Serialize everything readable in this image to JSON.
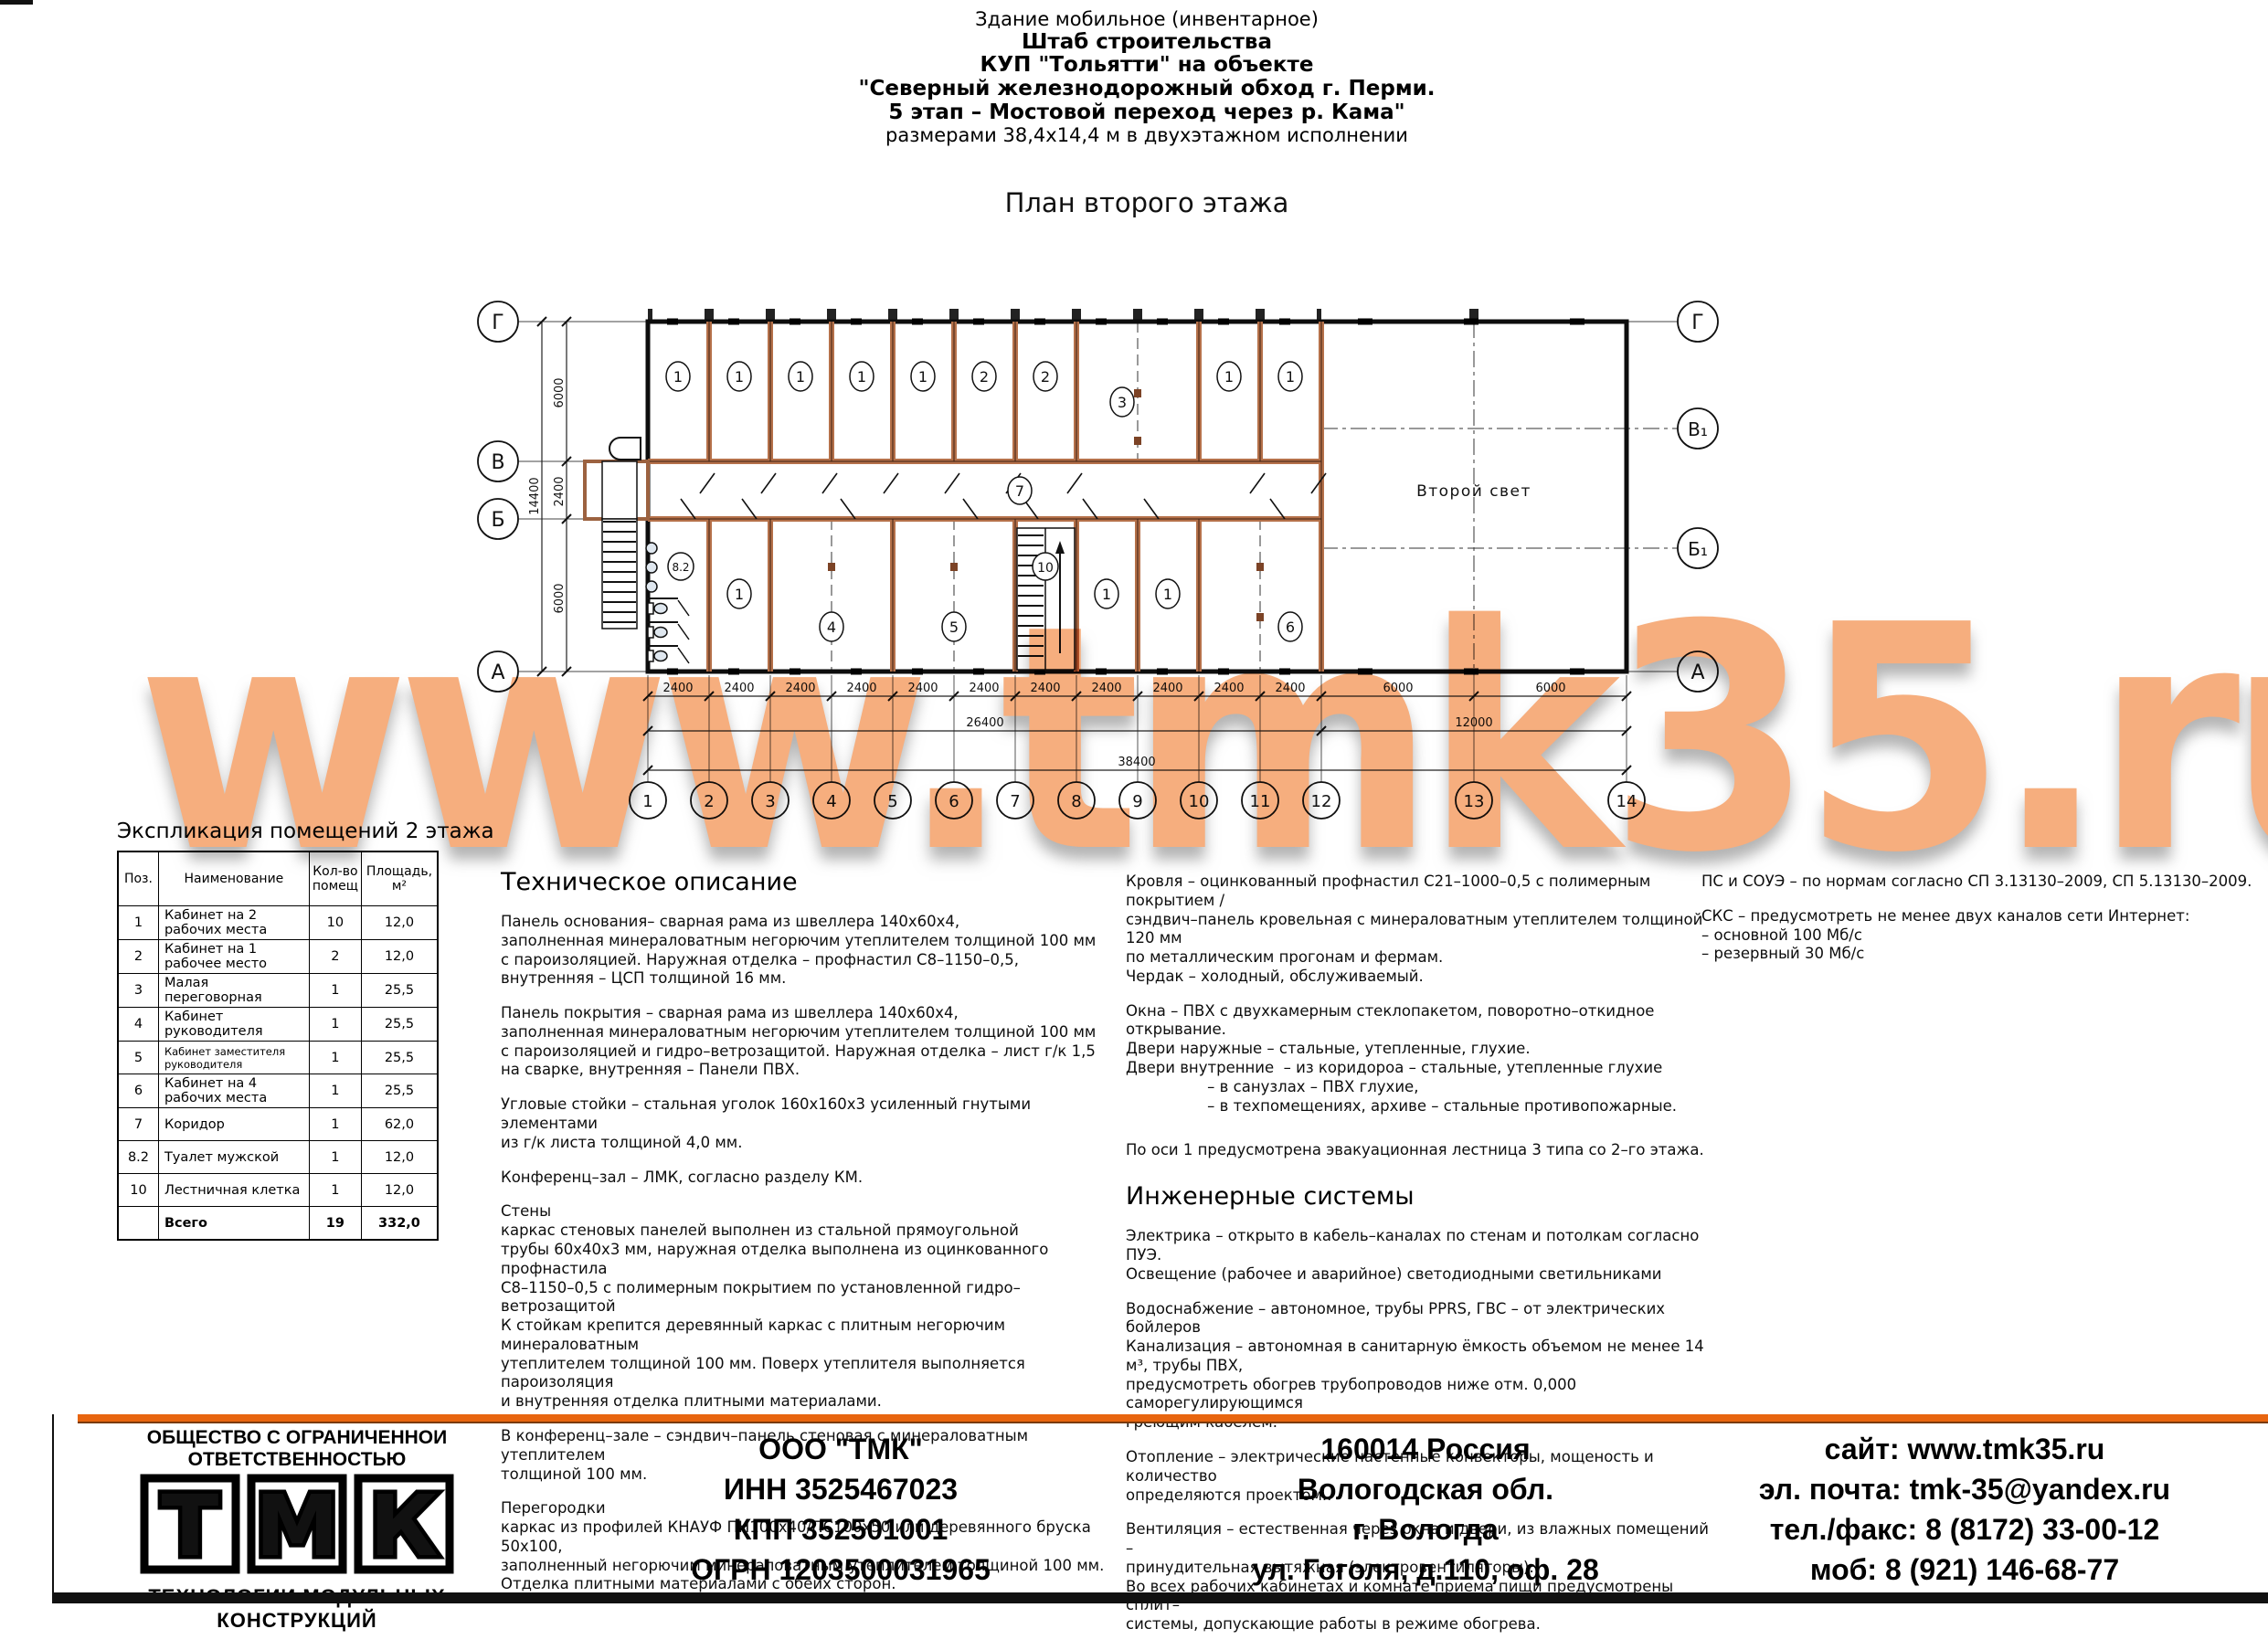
{
  "header": {
    "lines": [
      "Здание мобильное (инвентарное)",
      "Штаб строительства",
      "КУП \"Тольятти\" на объекте",
      "\"Северный железнодорожный обход г. Перми.",
      "5 этап – Мостовой переход через р. Кама\"",
      "размерами 38,4х14,4 м в двухэтажном исполнении"
    ]
  },
  "plan": {
    "title": "План второго этажа",
    "second_light": "Второй свет",
    "axes_left": [
      "Г",
      "В",
      "Б",
      "А"
    ],
    "axes_right": [
      "Г",
      "В₁",
      "Б₁",
      "А"
    ],
    "cols": [
      "1",
      "2",
      "3",
      "4",
      "5",
      "6",
      "7",
      "8",
      "9",
      "10",
      "11",
      "12",
      "13",
      "14"
    ],
    "rooms_top": [
      "1",
      "1",
      "1",
      "1",
      "1",
      "2",
      "2",
      "3",
      "1",
      "1"
    ],
    "corridor": "7",
    "rooms_bottom": [
      "8.2",
      "1",
      "4",
      "5",
      "10",
      "1",
      "1",
      "6"
    ],
    "dims": {
      "bay": "2400",
      "wide": "6000",
      "left_block": "26400",
      "right_block": "12000",
      "total": "38400",
      "v_top": "6000",
      "v_mid": "2400",
      "v_bottom": "6000",
      "v_total": "14400"
    }
  },
  "table": {
    "title": "Экспликация помещений 2 этажа",
    "headers": [
      "Поз.",
      "Наименование",
      "Кол-во помещ",
      "Площадь, м²"
    ],
    "rows": [
      [
        "1",
        "Кабинет на 2 рабочих места",
        "10",
        "12,0"
      ],
      [
        "2",
        "Кабинет на 1 рабочее место",
        "2",
        "12,0"
      ],
      [
        "3",
        "Малая переговорная",
        "1",
        "25,5"
      ],
      [
        "4",
        "Кабинет руководителя",
        "1",
        "25,5"
      ],
      [
        "5",
        "Кабинет заместителя руководителя",
        "1",
        "25,5"
      ],
      [
        "6",
        "Кабинет на 4 рабочих места",
        "1",
        "25,5"
      ],
      [
        "7",
        "Коридор",
        "1",
        "62,0"
      ],
      [
        "8.2",
        "Туалет мужской",
        "1",
        "12,0"
      ],
      [
        "10",
        "Лестничная клетка",
        "1",
        "12,0"
      ]
    ],
    "total": [
      "",
      "Всего",
      "19",
      "332,0"
    ]
  },
  "tech": {
    "heading": "Техническое описание",
    "p1": "Панель основания– сварная рама из швеллера 140х60х4,\nзаполненная минераловатным негорючим утеплителем толщиной 100 мм\nс пароизоляцией. Наружная отделка – профнастил С8–1150–0,5,\nвнутренняя – ЦСП толщиной 16 мм.",
    "p2": "Панель покрытия – сварная рама из швеллера 140х60х4,\nзаполненная минераловатным негорючим утеплителем толщиной 100 мм\nс пароизоляцией и гидро–ветрозащитой. Наружная отделка – лист г/к 1,5\nна сварке, внутренняя – Панели ПВХ.",
    "p3": "Угловые стойки – стальная уголок 160х160х3 усиленный гнутыми элементами\nиз г/к листа толщиной 4,0 мм.",
    "p4": "Конференц–зал – ЛМК, согласно разделу КМ.",
    "p5": "Стены\nкаркас стеновых панелей выполнен из стальной прямоугольной\nтрубы 60х40х3 мм, наружная отделка выполнена из оцинкованного профнастила\nС8–1150–0,5 с полимерным покрытием по установленной гидро–ветрозащитой\nК стойкам крепится деревянный каркас с плитным негорючим минераловатным\nутеплителем толщиной 100 мм. Поверх утеплителя выполняется пароизоляция\nи внутренняя отделка плитными материалами.",
    "p6": "В конференц–зале – сэндвич–панель стеновая с минераловатным утеплителем\nтолщиной 100 мм.",
    "p7": "Перегородки\nкаркас из профилей КНАУФ ПН100х40/ПС100х50 или деревянного бруска 50х100,\nзаполненный негорючим минераловатным утеплителем толщиной 100 мм.\nОтделка плитными материалами с обеих сторон."
  },
  "mid": {
    "p1": "Кровля – оцинкованный профнастил С21–1000–0,5 с полимерным покрытием /\nсэндвич–панель кровельная с минераловатным утеплителем толщиной 120 мм\nпо металлическим прогонам и фермам.\nЧердак – холодный, обслуживаемый.",
    "p2": "Окна – ПВХ с двухкамерным стеклопакетом, поворотно–откидное открывание.\nДвери наружные – стальные, утепленные, глухие.\nДвери внутренние  – из коридороа – стальные, утепленные глухие\n                 – в санузлах – ПВХ глухие,\n                 – в техпомещениях, архиве – стальные противопожарные.",
    "p3": "По оси 1 предусмотрена эвакуационная лестница 3 типа со 2–го этажа.",
    "heading2": "Инженерные системы",
    "p4": "Электрика – открыто в кабель–каналах по стенам и потолкам согласно ПУЭ.\nОсвещение (рабочее и аварийное) светодиодными светильниками",
    "p5": "Водоснабжение – автономное, трубы PPRS, ГВС – от электрических бойлеров\nКанализация – автономная в санитарную ёмкость объемом не менее 14 м³, трубы ПВХ,\nпредусмотреть обогрев трубопроводов ниже отм. 0,000 саморегулирующимся\nгреющим кабелем.",
    "p6": "Отопление – электрические настенные конвекторы, мощеность и количество\nопределяются проектом..",
    "p7": "Вентиляция – естественная через окна и двери, из влажных помещений –\nпринудительная вытяжная (электровентиляторы).\nВо всех рабочих кабинетах и комнате приема пищи предусмотрены сплит–\nсистемы, допускающие работы в режиме обогрева."
  },
  "right": {
    "p1": "ПС и СОУЭ – по нормам согласно СП 3.13130–2009, СП 5.13130–2009.",
    "p2": "СКС – предусмотреть не менее двух каналов сети Интернет:\n– основной 100 Мб/с\n– резервный 30 Мб/с"
  },
  "watermark": {
    "text": "www.tmk35.ru",
    "color": "#F6AE7E"
  },
  "footer": {
    "company_type": "ОБЩЕСТВО С ОГРАНИЧЕННОИ ОТВЕТСТВЕННОСТЬЮ",
    "logo_letters": [
      "Т",
      "М",
      "К"
    ],
    "logo_accent": "#F07818",
    "logo_sub": "ТЕХНОЛОГИИ  МОДУЛЬНЫХ  КОНСТРУКЦИЙ",
    "col1": [
      "ООО \"ТМК\"",
      "ИНН 3525467023",
      "КПП 352501001",
      "ОГРН 1203500031965"
    ],
    "col2": [
      "160014 Россия",
      "Вологодская обл.",
      "г. Вологда",
      "ул. Гоголя, д.110, оф. 28"
    ],
    "col3": [
      "сайт: www.tmk35.ru",
      "эл. почта: tmk-35@yandex.ru",
      "тел./факс: 8 (8172) 33-00-12",
      "моб: 8 (921) 146-68-77"
    ]
  }
}
